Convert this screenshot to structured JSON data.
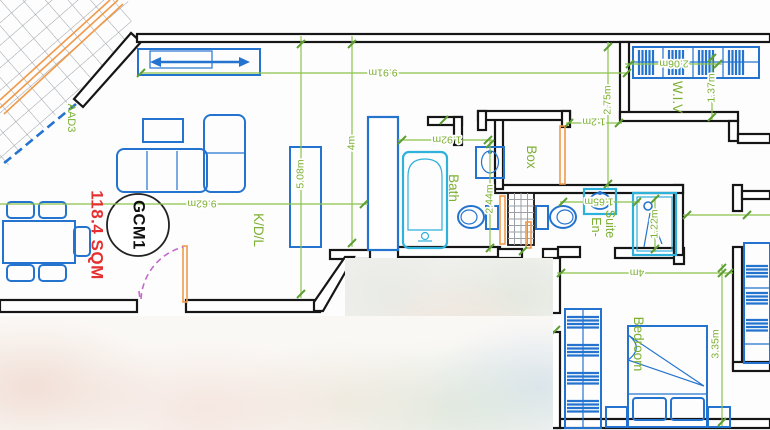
{
  "plan": {
    "unit_circle_label": "GCM1",
    "area_label": "118.4 SQM",
    "terrace_code": "AAD3",
    "rooms": {
      "kdl": "K/D/L",
      "bath": "Bath",
      "box": "Box",
      "ensuite_top": "En-",
      "ensuite_bottom": "Suite",
      "wiv": "W.I.V",
      "bedroom": "Bedroom"
    },
    "dimensions": {
      "top_overall": "9.91m",
      "living_width": "9.62m",
      "living_depth": "5.08m",
      "kitchen_span": "4m",
      "bath_width": "1.92m",
      "bath_depth": "2.44m",
      "box_door": "1.2m",
      "wiv_depth": "2.75m",
      "wiv_width": "2.06m",
      "wiv_clear": "1.37m",
      "ensuite_width": "1.65m",
      "shower_width": "1.22m",
      "bedroom_width": "4m",
      "bedroom_depth": "3.35m"
    },
    "colors": {
      "walls": "#161616",
      "furniture": "#2474cf",
      "fixtures": "#2fb1dc",
      "dimensions": "#7cb031",
      "area_text": "#e53030",
      "doors": "#f09a4b",
      "door_swing": "#c468cf"
    }
  }
}
